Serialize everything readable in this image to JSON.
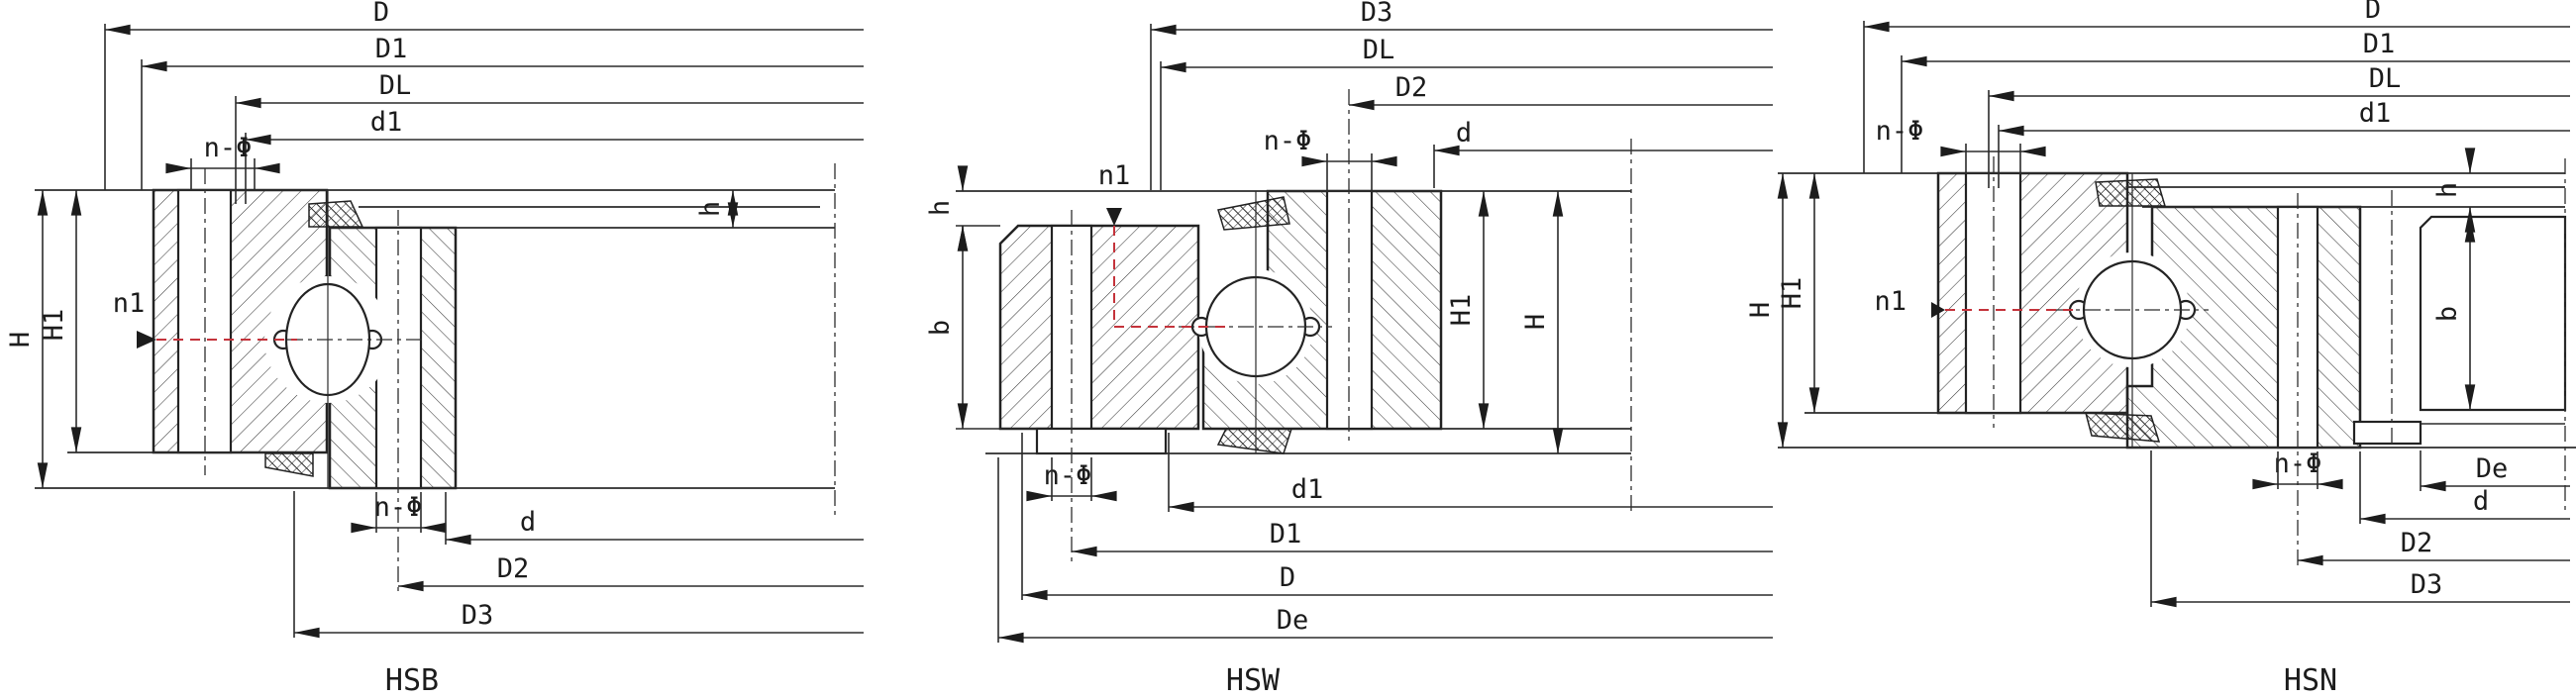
{
  "colors": {
    "background": "#ffffff",
    "line": "#232323",
    "accent_red": "#c4333b"
  },
  "diagrams": [
    {
      "id": "hsb",
      "title": "HSB",
      "labels": {
        "D": "D",
        "D1": "D1",
        "DL": "DL",
        "d1": "d1",
        "nphi_top": "n-Φ",
        "nphi_bottom": "n-Φ",
        "H": "H",
        "H1": "H1",
        "n1": "n1",
        "h": "h",
        "d": "d",
        "D2": "D2",
        "D3": "D3"
      }
    },
    {
      "id": "hsw",
      "title": "HSW",
      "labels": {
        "D3": "D3",
        "DL": "DL",
        "D2": "D2",
        "d": "d",
        "nphi_top": "n-Φ",
        "nphi_bottom": "n-Φ",
        "n1": "n1",
        "h": "h",
        "b": "b",
        "H1": "H1",
        "H": "H",
        "d1": "d1",
        "D1": "D1",
        "D": "D",
        "De": "De"
      }
    },
    {
      "id": "hsn",
      "title": "HSN",
      "labels": {
        "D": "D",
        "D1": "D1",
        "DL": "DL",
        "d1": "d1",
        "nphi_top": "n-Φ",
        "nphi_bottom": "n-Φ",
        "H": "H",
        "H1": "H1",
        "n1": "n1",
        "h": "h",
        "b": "b",
        "De": "De",
        "d": "d",
        "D2": "D2",
        "D3": "D3"
      }
    }
  ]
}
